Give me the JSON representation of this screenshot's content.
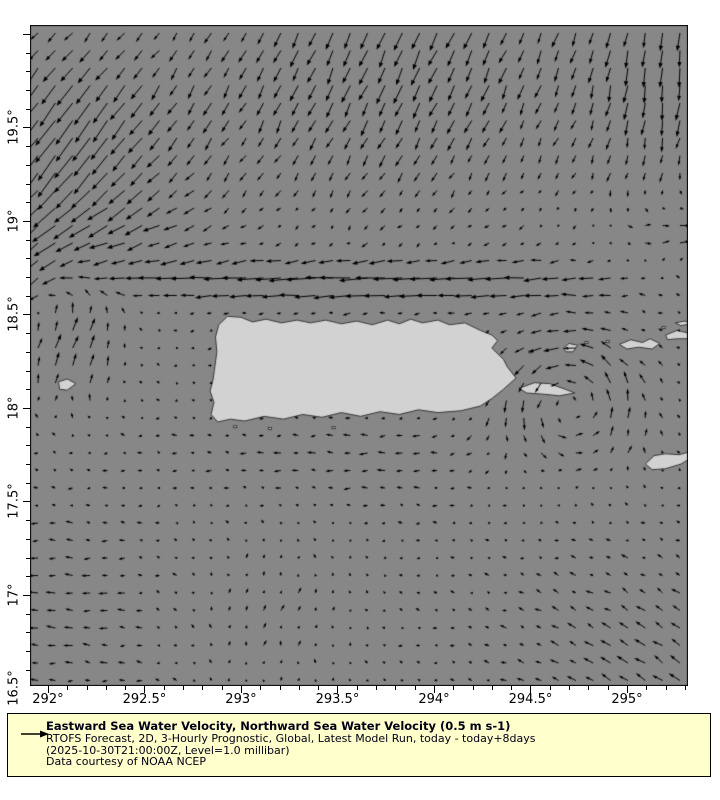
{
  "figure": {
    "width": 720,
    "height": 800,
    "background": "#ffffff"
  },
  "map": {
    "ocean_color": "#878787",
    "land_color": "#d2d2d2",
    "coast_color": "#383838",
    "frame_color": "#000000",
    "frame": {
      "left": 30,
      "top": 25,
      "width": 658,
      "height": 661
    }
  },
  "chart_data": {
    "type": "quiver",
    "title": "Eastward Sea Water Velocity, Northward Sea Water Velocity",
    "units": "m s-1",
    "reference_vector_ms": 0.5,
    "xlabel": "longitude (deg E)",
    "ylabel": "latitude (deg N)",
    "xlim": [
      291.907,
      295.316
    ],
    "ylim": [
      16.513,
      20.048
    ],
    "x_ticks": [
      {
        "value": 292,
        "label": "292°"
      },
      {
        "value": 292.5,
        "label": "292.5°"
      },
      {
        "value": 293,
        "label": "293°"
      },
      {
        "value": 293.5,
        "label": "293.5°"
      },
      {
        "value": 294,
        "label": "294°"
      },
      {
        "value": 294.5,
        "label": "294.5°"
      },
      {
        "value": 295,
        "label": "295°"
      }
    ],
    "y_ticks": [
      {
        "value": 16.5,
        "label": "16.5°"
      },
      {
        "value": 17,
        "label": "17°"
      },
      {
        "value": 17.5,
        "label": "17.5°"
      },
      {
        "value": 18,
        "label": "18°"
      },
      {
        "value": 18.5,
        "label": "18.5°"
      },
      {
        "value": 19,
        "label": "19°"
      },
      {
        "value": 19.5,
        "label": "19.5°"
      }
    ],
    "minor_tick_step_deg": 0.1,
    "grid": {
      "nx": 38,
      "ny": 38,
      "x0_px": 8,
      "y0_px": 8,
      "dx_px": 17.35,
      "dy_px": 17.5
    },
    "arrow_scale_px_per_ms": 50,
    "arrow_color": "#000000",
    "background_uv": [
      -0.05,
      0.0
    ],
    "noise_amp_ms": 0.04,
    "flow_components": [
      {
        "name": "topleft-southwest-surge",
        "cx": 291.9,
        "cy": 19.45,
        "sx": 0.75,
        "sy": 0.5,
        "u": -0.34,
        "v": -0.5
      },
      {
        "name": "left-edge-southward",
        "cx": 291.88,
        "cy": 18.8,
        "sx": 0.18,
        "sy": 0.3,
        "u": -0.22,
        "v": -0.38
      },
      {
        "name": "top-middle-ssw-flow",
        "cx": 293.8,
        "cy": 19.9,
        "sx": 1.1,
        "sy": 0.75,
        "u": -0.1,
        "v": -0.36
      },
      {
        "name": "top-right-southward",
        "cx": 295.25,
        "cy": 19.8,
        "sx": 0.5,
        "sy": 0.6,
        "u": 0.02,
        "v": -0.3
      },
      {
        "name": "westward-jet-north-of-pr",
        "cx": 293.6,
        "cy": 18.68,
        "sx": 1.3,
        "sy": 0.12,
        "u": -0.55,
        "v": 0.0
      },
      {
        "name": "jet-west-extension",
        "cx": 292.3,
        "cy": 18.95,
        "sx": 0.5,
        "sy": 0.22,
        "u": -0.25,
        "v": -0.05
      },
      {
        "name": "northeast-of-vi-eastward",
        "cx": 295.3,
        "cy": 18.9,
        "sx": 0.4,
        "sy": 0.22,
        "u": 0.25,
        "v": 0.07
      },
      {
        "name": "mona-passage-northward",
        "cx": 292.1,
        "cy": 18.35,
        "sx": 0.3,
        "sy": 0.35,
        "u": 0.16,
        "v": 0.3
      },
      {
        "name": "bottom-right-northwest",
        "cx": 295.3,
        "cy": 16.55,
        "sx": 0.9,
        "sy": 0.65,
        "u": -0.16,
        "v": 0.14
      },
      {
        "name": "bottom-left-westward",
        "cx": 292.0,
        "cy": 16.9,
        "sx": 0.6,
        "sy": 0.55,
        "u": -0.14,
        "v": 0.01
      },
      {
        "name": "bottom-middle-northeast",
        "cx": 293.15,
        "cy": 16.9,
        "sx": 0.45,
        "sy": 0.5,
        "u": 0.09,
        "v": 0.09
      },
      {
        "name": "south-coast-westward",
        "cx": 293.6,
        "cy": 17.75,
        "sx": 0.9,
        "sy": 0.25,
        "u": -0.1,
        "v": 0.0
      }
    ],
    "eddies": [
      {
        "name": "cyclonic-eddy-east-of-pr",
        "cx": 294.7,
        "cy": 18.05,
        "omega": 1.6,
        "env": 0.12
      }
    ]
  },
  "land": {
    "polygons": [
      {
        "name": "puerto-rico",
        "points": [
          [
            292.862,
            18.2
          ],
          [
            292.875,
            18.3
          ],
          [
            292.868,
            18.38
          ],
          [
            292.885,
            18.445
          ],
          [
            292.93,
            18.49
          ],
          [
            293.0,
            18.485
          ],
          [
            293.06,
            18.46
          ],
          [
            293.13,
            18.475
          ],
          [
            293.21,
            18.455
          ],
          [
            293.29,
            18.47
          ],
          [
            293.36,
            18.455
          ],
          [
            293.44,
            18.47
          ],
          [
            293.52,
            18.45
          ],
          [
            293.6,
            18.465
          ],
          [
            293.68,
            18.445
          ],
          [
            293.76,
            18.47
          ],
          [
            293.82,
            18.45
          ],
          [
            293.88,
            18.475
          ],
          [
            293.94,
            18.455
          ],
          [
            294.02,
            18.47
          ],
          [
            294.08,
            18.445
          ],
          [
            294.16,
            18.455
          ],
          [
            294.24,
            18.415
          ],
          [
            294.3,
            18.39
          ],
          [
            294.33,
            18.36
          ],
          [
            294.3,
            18.32
          ],
          [
            294.36,
            18.26
          ],
          [
            294.38,
            18.22
          ],
          [
            294.425,
            18.16
          ],
          [
            294.36,
            18.1
          ],
          [
            294.3,
            18.05
          ],
          [
            294.24,
            18.01
          ],
          [
            294.14,
            17.985
          ],
          [
            294.02,
            17.975
          ],
          [
            293.92,
            17.99
          ],
          [
            293.82,
            17.965
          ],
          [
            293.72,
            17.98
          ],
          [
            293.62,
            17.955
          ],
          [
            293.52,
            17.975
          ],
          [
            293.42,
            17.95
          ],
          [
            293.32,
            17.965
          ],
          [
            293.22,
            17.94
          ],
          [
            293.12,
            17.955
          ],
          [
            293.02,
            17.93
          ],
          [
            292.945,
            17.94
          ],
          [
            292.88,
            17.925
          ],
          [
            292.845,
            17.965
          ],
          [
            292.86,
            18.03
          ],
          [
            292.84,
            18.09
          ],
          [
            292.855,
            18.15
          ]
        ]
      },
      {
        "name": "vieques",
        "points": [
          [
            294.44,
            18.105
          ],
          [
            294.52,
            18.135
          ],
          [
            294.6,
            18.13
          ],
          [
            294.68,
            18.1
          ],
          [
            294.73,
            18.08
          ],
          [
            294.65,
            18.065
          ],
          [
            294.55,
            18.075
          ],
          [
            294.48,
            18.08
          ]
        ]
      },
      {
        "name": "culebra",
        "points": [
          [
            294.67,
            18.32
          ],
          [
            294.7,
            18.345
          ],
          [
            294.745,
            18.335
          ],
          [
            294.72,
            18.3
          ],
          [
            294.685,
            18.3
          ]
        ]
      },
      {
        "name": "st-thomas-st-john",
        "points": [
          [
            294.96,
            18.34
          ],
          [
            295.02,
            18.365
          ],
          [
            295.08,
            18.35
          ],
          [
            295.12,
            18.37
          ],
          [
            295.17,
            18.345
          ],
          [
            295.13,
            18.315
          ],
          [
            295.06,
            18.325
          ],
          [
            295.0,
            18.315
          ]
        ]
      },
      {
        "name": "tortola-virgin-gorda",
        "points": [
          [
            295.2,
            18.39
          ],
          [
            295.26,
            18.415
          ],
          [
            295.32,
            18.4
          ],
          [
            295.38,
            18.41
          ],
          [
            295.33,
            18.37
          ],
          [
            295.26,
            18.37
          ],
          [
            295.21,
            18.365
          ]
        ]
      },
      {
        "name": "anegada",
        "points": [
          [
            295.25,
            18.455
          ],
          [
            295.3,
            18.465
          ],
          [
            295.33,
            18.45
          ],
          [
            295.28,
            18.44
          ]
        ]
      },
      {
        "name": "st-croix",
        "points": [
          [
            295.095,
            17.7
          ],
          [
            295.14,
            17.745
          ],
          [
            295.2,
            17.755
          ],
          [
            295.27,
            17.75
          ],
          [
            295.34,
            17.77
          ],
          [
            295.36,
            17.75
          ],
          [
            295.28,
            17.7
          ],
          [
            295.2,
            17.675
          ],
          [
            295.13,
            17.67
          ]
        ]
      },
      {
        "name": "mona-island",
        "points": [
          [
            292.055,
            18.14
          ],
          [
            292.1,
            18.155
          ],
          [
            292.145,
            18.13
          ],
          [
            292.1,
            18.095
          ],
          [
            292.06,
            18.1
          ]
        ]
      }
    ],
    "islets": [
      [
        294.9,
        18.355
      ],
      [
        294.79,
        18.35
      ],
      [
        295.19,
        18.43
      ],
      [
        294.5,
        18.3
      ],
      [
        293.15,
        17.89
      ],
      [
        293.48,
        17.895
      ],
      [
        292.97,
        17.9
      ]
    ]
  },
  "legend": {
    "title": "Eastward Sea Water Velocity, Northward Sea Water Velocity (0.5 m s-1)",
    "source": "RTOFS Forecast, 2D, 3-Hourly Prognostic, Global, Latest Model Run, today - today+8days",
    "time": "(2025-10-30T21:00:00Z, Level=1.0 millibar)",
    "credit": "Data courtesy of NOAA NCEP",
    "background": "#ffffcc",
    "border_color": "#000000",
    "arrow_icon": "reference-arrow"
  }
}
